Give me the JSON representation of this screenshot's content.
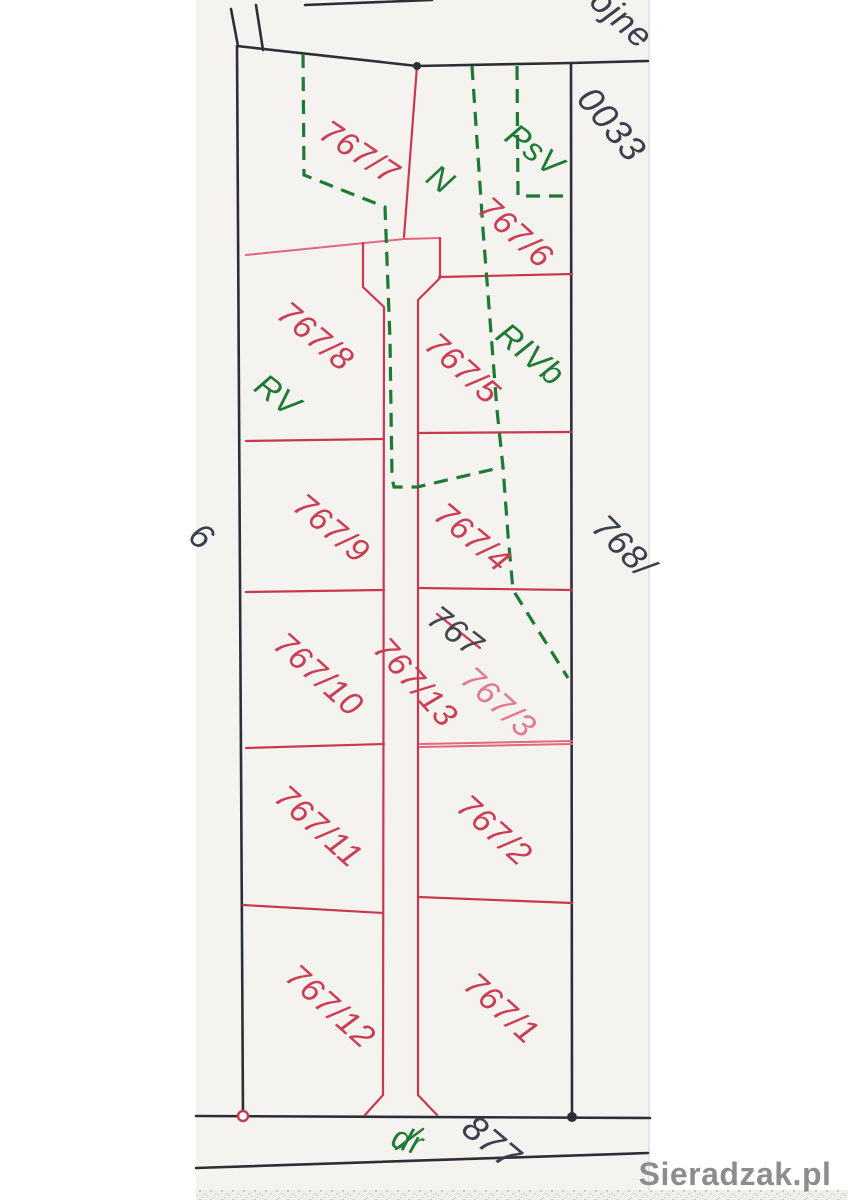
{
  "map_type": "cadastral-parcel-map-scan",
  "labels": {
    "street_fragment": "ojne",
    "sheet_number": "0033",
    "parcel_767_7": "767/7",
    "use_n": "N",
    "use_psv": "PsV",
    "parcel_767_6": "767/6",
    "parcel_767_8": "767/8",
    "use_rv": "RV",
    "parcel_767_5": "767/5",
    "use_rivb": "RIVb",
    "parcel_767_9": "767/9",
    "parcel_767_4": "767/4",
    "neighbor_768": "768/",
    "neighbor_fragment_left": "6",
    "parcel_767_10": "767/10",
    "parcel_767_13": "767/13",
    "crossed_out_767": "767",
    "old_parcel_767_3": "767/3",
    "parcel_767_11": "767/11",
    "parcel_767_2": "767/2",
    "parcel_767_12": "767/12",
    "parcel_767_1": "767/1",
    "road_use_symbol": "dr",
    "road_parcel_877": "877",
    "watermark": "Sieradzak.pl"
  },
  "colors": {
    "paper": "#f4f3f0",
    "boundary_black": "#2e2f36",
    "parcel_red": "#c9394e",
    "parcel_red_light": "#e0697f",
    "label_red": "#cc3d53",
    "label_pink": "#e2798f",
    "use_green": "#1e7a33",
    "ink_navy": "#3a3f4e",
    "label_dark": "#45454d",
    "watermark_gray": "#8d8d91"
  }
}
